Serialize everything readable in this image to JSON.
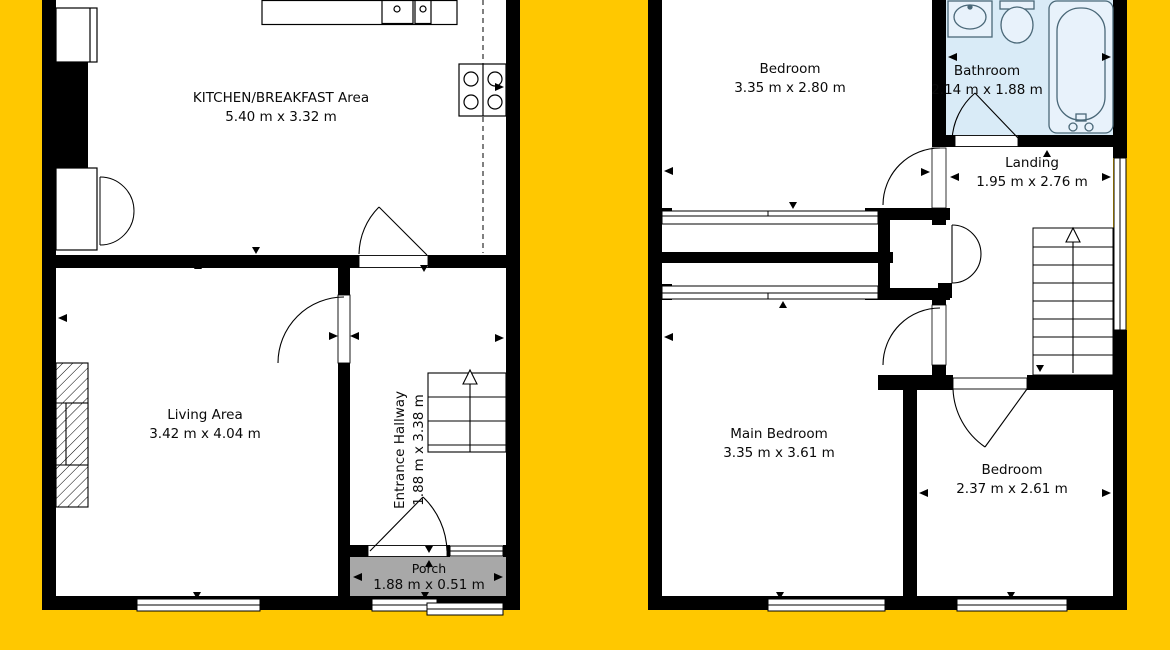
{
  "document_type": "property floor plan",
  "colors": {
    "background": "#ffc800",
    "walls": "#000000",
    "porch_fill": "#a8a8a8",
    "bathroom_fill": "#d9ebf7",
    "fixture_stroke": "#4a6878"
  },
  "ground_floor": {
    "rooms": [
      {
        "id": "kitchen",
        "name": "KITCHEN/BREAKFAST Area",
        "dims": "5.40 m x 3.32 m"
      },
      {
        "id": "living",
        "name": "Living Area",
        "dims": "3.42 m x 4.04 m"
      },
      {
        "id": "hallway",
        "name": "Entrance Hallway",
        "dims": "1.88 m x 3.38 m"
      },
      {
        "id": "porch",
        "name": "Porch",
        "dims": "1.88 m x 0.51 m"
      }
    ]
  },
  "first_floor": {
    "rooms": [
      {
        "id": "bedroom1",
        "name": "Bedroom",
        "dims": "3.35 m x 2.80 m"
      },
      {
        "id": "bathroom",
        "name": "Bathroom",
        "dims": "2.14 m x 1.88 m"
      },
      {
        "id": "landing",
        "name": "Landing",
        "dims": "1.95 m x 2.76 m"
      },
      {
        "id": "main_bedroom",
        "name": "Main Bedroom",
        "dims": "3.35 m x 3.61 m"
      },
      {
        "id": "bedroom2",
        "name": "Bedroom",
        "dims": "2.37 m x 2.61 m"
      }
    ]
  }
}
